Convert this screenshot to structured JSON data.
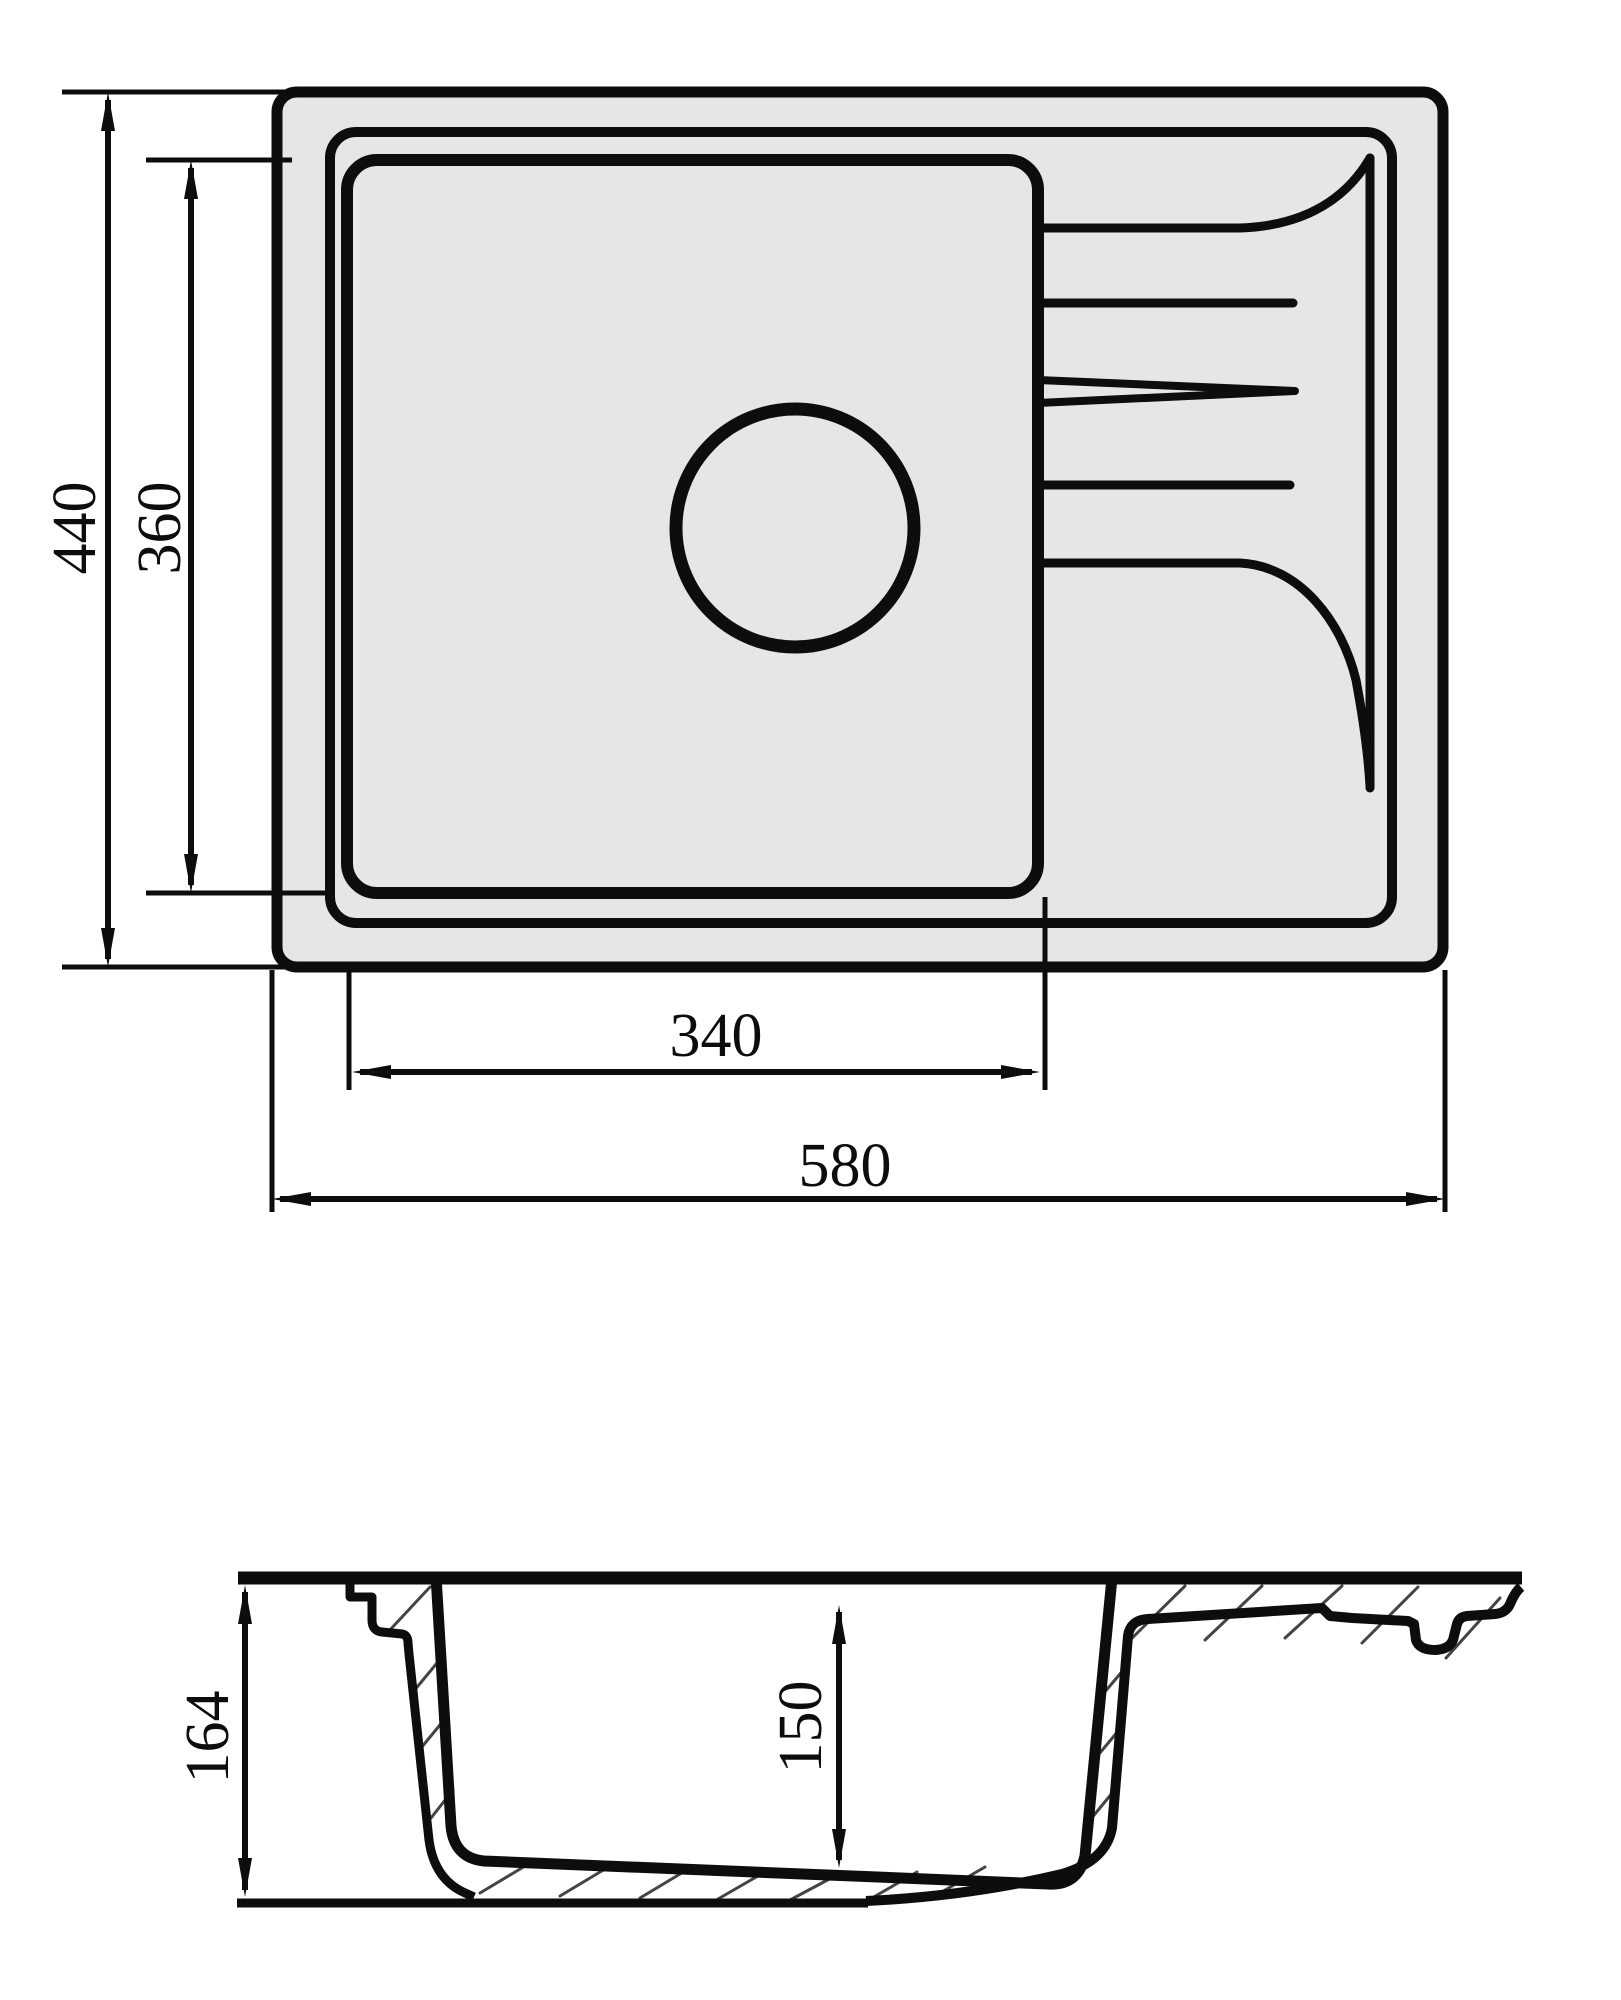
{
  "diagram": {
    "type": "technical-drawing",
    "subject": "kitchen sink with bowl, drainboard and cross-section",
    "units": "mm",
    "colors": {
      "line": "#0d0d0d",
      "sink_fill": "#e6e6e6",
      "background": "#ffffff",
      "hatch": "#444444"
    },
    "top_view": {
      "dimensions": {
        "overall_depth": "440",
        "bowl_depth": "360",
        "bowl_width": "340",
        "overall_width": "580"
      }
    },
    "section_view": {
      "dimensions": {
        "overall_height": "164",
        "bowl_inner_depth": "150"
      }
    }
  }
}
